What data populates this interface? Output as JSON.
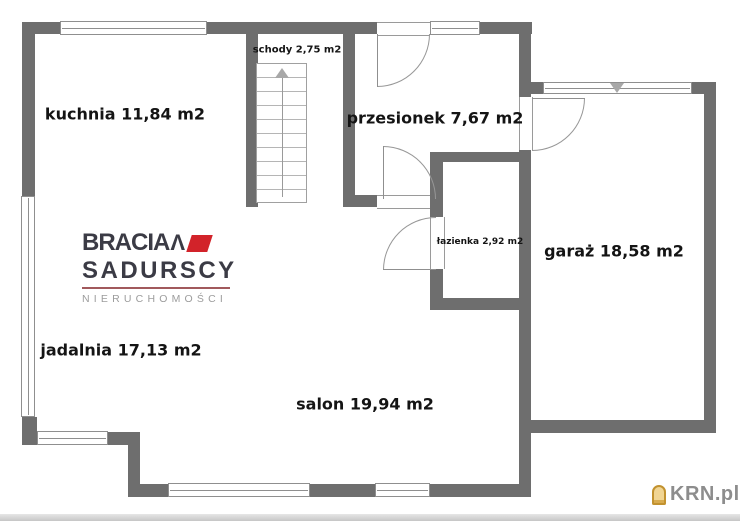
{
  "watermark": {
    "text": "KRN.pl",
    "icon": "house-icon"
  },
  "logo": {
    "name_top": "BRACIA",
    "caret": "Λ",
    "name_bottom": "SADURSCY",
    "subtitle": "NIERUCHOMOŚCI",
    "accent_red": "#d2232a",
    "dark": "#3b3b45",
    "rule_color": "#a1595c"
  },
  "plan": {
    "colors": {
      "wall": "#6e6e6e",
      "thin_line": "#8f8f8f",
      "label": "#141414",
      "background": "#ffffff"
    },
    "rooms": [
      {
        "id": "kuchnia",
        "label": "kuchnia 11,84 m2",
        "cx": 125,
        "cy": 114,
        "size": 16
      },
      {
        "id": "schody",
        "label": "schody 2,75 m2",
        "cx": 297,
        "cy": 50,
        "size": 10
      },
      {
        "id": "przesionek",
        "label": "przesionek 7,67 m2",
        "cx": 435,
        "cy": 118,
        "size": 16
      },
      {
        "id": "lazienka",
        "label": "łazienka 2,92 m2",
        "cx": 480,
        "cy": 242,
        "size": 9
      },
      {
        "id": "garaz",
        "label": "garaż 18,58 m2",
        "cx": 614,
        "cy": 251,
        "size": 16
      },
      {
        "id": "jadalnia",
        "label": "jadalnia 17,13 m2",
        "cx": 121,
        "cy": 350,
        "size": 16
      },
      {
        "id": "salon",
        "label": "salon 19,94 m2",
        "cx": 365,
        "cy": 404,
        "size": 16
      }
    ],
    "walls": [
      {
        "x": 22,
        "y": 22,
        "w": 355,
        "h": 12
      },
      {
        "x": 480,
        "y": 22,
        "w": 52,
        "h": 12
      },
      {
        "x": 22,
        "y": 22,
        "w": 13,
        "h": 174
      },
      {
        "x": 22,
        "y": 417,
        "w": 15,
        "h": 28
      },
      {
        "x": 35,
        "y": 432,
        "w": 105,
        "h": 13
      },
      {
        "x": 128,
        "y": 443,
        "w": 12,
        "h": 46
      },
      {
        "x": 128,
        "y": 484,
        "w": 403,
        "h": 13
      },
      {
        "x": 246,
        "y": 34,
        "w": 12,
        "h": 173
      },
      {
        "x": 343,
        "y": 22,
        "w": 12,
        "h": 185
      },
      {
        "x": 343,
        "y": 195,
        "w": 34,
        "h": 12
      },
      {
        "x": 430,
        "y": 152,
        "w": 13,
        "h": 65
      },
      {
        "x": 430,
        "y": 269,
        "w": 13,
        "h": 41
      },
      {
        "x": 435,
        "y": 152,
        "w": 96,
        "h": 10
      },
      {
        "x": 435,
        "y": 298,
        "w": 96,
        "h": 12
      },
      {
        "x": 519,
        "y": 22,
        "w": 12,
        "h": 75
      },
      {
        "x": 531,
        "y": 82,
        "w": 12,
        "h": 12
      },
      {
        "x": 692,
        "y": 82,
        "w": 24,
        "h": 12
      },
      {
        "x": 704,
        "y": 82,
        "w": 12,
        "h": 351
      },
      {
        "x": 531,
        "y": 420,
        "w": 185,
        "h": 13
      },
      {
        "x": 519,
        "y": 150,
        "w": 12,
        "h": 347
      }
    ],
    "door_gaps": [
      {
        "x": 377,
        "y": 22,
        "w": 53,
        "h": 12,
        "o": "h"
      },
      {
        "x": 519,
        "y": 97,
        "w": 12,
        "h": 53,
        "o": "v"
      },
      {
        "x": 377,
        "y": 195,
        "w": 53,
        "h": 12,
        "o": "h"
      },
      {
        "x": 430,
        "y": 217,
        "w": 13,
        "h": 52,
        "o": "v"
      }
    ],
    "windows": [
      {
        "x": 60,
        "y": 21,
        "w": 147,
        "h": 14,
        "o": "h"
      },
      {
        "x": 430,
        "y": 21,
        "w": 50,
        "h": 14,
        "o": "h"
      },
      {
        "x": 21,
        "y": 196,
        "w": 14,
        "h": 221,
        "o": "v"
      },
      {
        "x": 37,
        "y": 431,
        "w": 71,
        "h": 14,
        "o": "h"
      },
      {
        "x": 168,
        "y": 483,
        "w": 142,
        "h": 14,
        "o": "h"
      },
      {
        "x": 375,
        "y": 483,
        "w": 55,
        "h": 14,
        "o": "h"
      },
      {
        "x": 543,
        "y": 82,
        "w": 149,
        "h": 12,
        "o": "h"
      }
    ],
    "doors": [
      {
        "x": 377,
        "y": 34,
        "s": 53,
        "corner": "br",
        "leaf": {
          "x": 377,
          "y": 34,
          "len": 53,
          "dir": "v"
        }
      },
      {
        "x": 532,
        "y": 98,
        "s": 53,
        "corner": "br",
        "leaf": {
          "x": 532,
          "y": 98,
          "len": 53,
          "dir": "h"
        }
      },
      {
        "x": 383,
        "y": 146,
        "s": 53,
        "corner": "tr",
        "leaf": {
          "x": 383,
          "y": 146,
          "len": 53,
          "dir": "v"
        }
      },
      {
        "x": 383,
        "y": 217,
        "s": 53,
        "corner": "tl",
        "leaf": {
          "x": 383,
          "y": 269,
          "len": 53,
          "dir": "h"
        }
      }
    ],
    "stairs": {
      "x": 256,
      "y": 63,
      "w": 51,
      "h": 140,
      "steps": 10,
      "direction_arrow": "up"
    },
    "markers": [
      {
        "type": "triangle-down",
        "x": 610,
        "y": 83,
        "meaning": "garage-gate-marker"
      }
    ]
  }
}
